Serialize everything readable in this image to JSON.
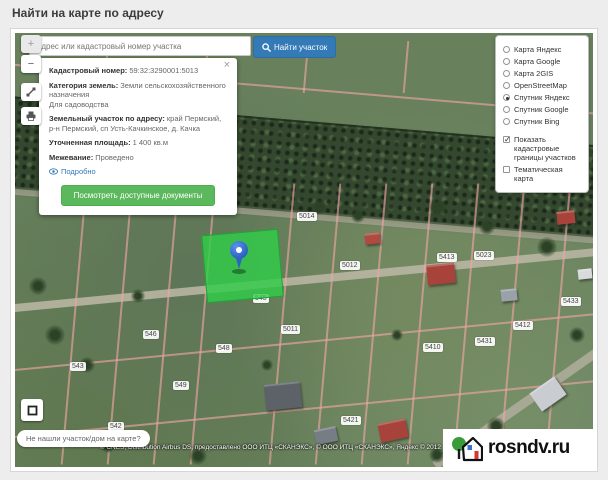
{
  "header": {
    "title": "Найти на карте по адресу"
  },
  "search": {
    "placeholder": "Адрес или кадастровый номер участка",
    "button_label": "Найти участок"
  },
  "map_controls": {
    "zoom_in": "+",
    "zoom_out": "−"
  },
  "popup": {
    "close": "×",
    "cadnum_label": "Кадастровый номер:",
    "cadnum_value": "59:32:3290001:5013",
    "category_label": "Категория земель:",
    "category_value": "Земли сельскохозяйственного назначения",
    "category_value2": "Для садоводства",
    "address_label": "Земельный участок по адресу:",
    "address_value": "край Пермский, р-н Пермский, сп Усть-Качкинское, д. Качка",
    "area_label": "Уточненная площадь:",
    "area_value": "1 400 кв.м",
    "mezh_label": "Межевание:",
    "mezh_value": "Проведено",
    "details_link": "Подробно",
    "docs_button": "Посмотреть доступные документы"
  },
  "layers_panel": {
    "options": [
      {
        "label": "Карта Яндекс",
        "selected": false
      },
      {
        "label": "Карта Google",
        "selected": false
      },
      {
        "label": "Карта 2GIS",
        "selected": false
      },
      {
        "label": "OpenStreetMap",
        "selected": false
      },
      {
        "label": "Спутник Яндекс",
        "selected": true
      },
      {
        "label": "Спутник Google",
        "selected": false
      },
      {
        "label": "Спутник Bing",
        "selected": false
      }
    ],
    "checkboxes": [
      {
        "label": "Показать кадастровые границы участков",
        "checked": true
      },
      {
        "label": "Тематическая карта",
        "checked": false
      }
    ]
  },
  "map": {
    "parcel_labels": [
      {
        "text": "5014"
      },
      {
        "text": "5012"
      },
      {
        "text": "5011"
      },
      {
        "text": "5413"
      },
      {
        "text": "5023"
      },
      {
        "text": "5433"
      },
      {
        "text": "5412"
      },
      {
        "text": "5410"
      },
      {
        "text": "5431"
      },
      {
        "text": "545"
      },
      {
        "text": "546"
      },
      {
        "text": "548"
      },
      {
        "text": "549"
      },
      {
        "text": "543"
      },
      {
        "text": "5421"
      },
      {
        "text": "542"
      }
    ]
  },
  "footer": {
    "not_found_label": "Не нашли участок/дом на карте?",
    "attribution": "© CNES, Distribution Airbus DS, предоставлено ООО ИТЦ «СКАНЭКС», © ООО ИТЦ «СКАНЭКС», Яндекс © 2012"
  },
  "watermark": {
    "text": "rosndv.ru"
  },
  "colors": {
    "accent_blue": "#337ab7",
    "button_green": "#5cb85c",
    "parcel_highlight": "#2fce48"
  }
}
